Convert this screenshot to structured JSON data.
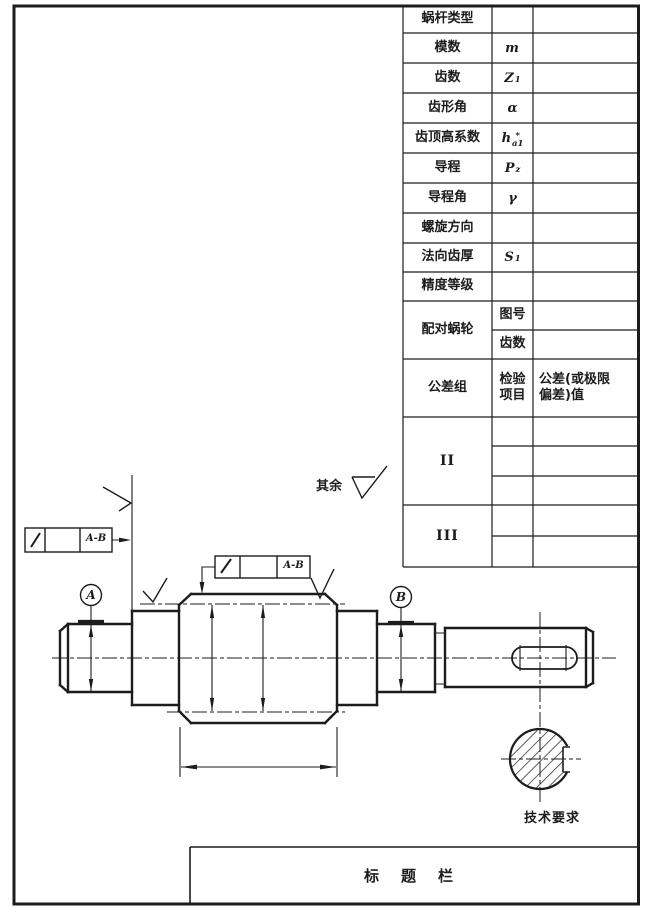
{
  "page": {
    "background": "#ffffff",
    "ink": "#1c1c1c"
  },
  "table": {
    "rows": [
      {
        "label": "蜗杆类型",
        "sym": ""
      },
      {
        "label": "模数",
        "sym": "m"
      },
      {
        "label": "齿数",
        "sym": "Z",
        "sub": "1"
      },
      {
        "label": "齿形角",
        "sym": "α"
      },
      {
        "label": "齿顶高系数",
        "sym": "h",
        "sup": "*",
        "sub": "a1"
      },
      {
        "label": "导程",
        "sym": "P",
        "sub": "z"
      },
      {
        "label": "导程角",
        "sym": "γ"
      },
      {
        "label": "螺旋方向",
        "sym": ""
      },
      {
        "label": "法向齿厚",
        "sym": "S",
        "sub": "1"
      },
      {
        "label": "精度等级",
        "sym": ""
      }
    ],
    "pair_worm": {
      "label": "配对蜗轮",
      "sub_rows": [
        "图号",
        "齿数"
      ]
    },
    "tolerance_group": {
      "label": "公差组",
      "col2": "检验项目",
      "col3_line1": "公差(或极限",
      "col3_line2": "偏差)值"
    },
    "group_II": "II",
    "group_III": "III"
  },
  "drawing": {
    "qiyu_label": "其余",
    "datum_a": "A",
    "datum_b": "B",
    "frame1_ref": "A-B",
    "frame2_ref": "A-B",
    "tech_label": "技术要求",
    "title_label": "标题栏"
  }
}
